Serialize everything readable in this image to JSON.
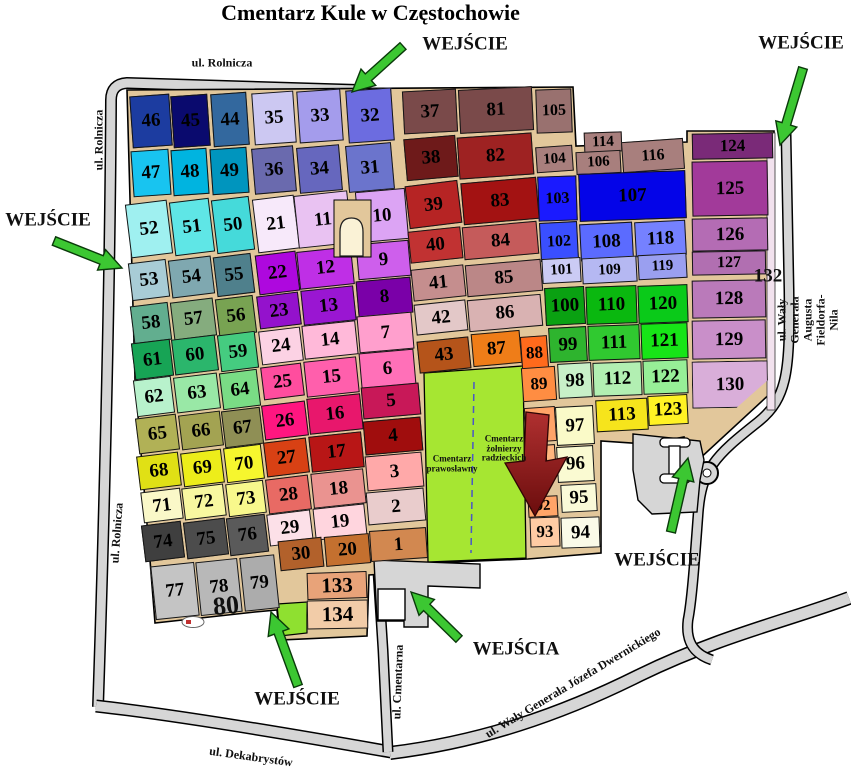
{
  "title": "Cmentarz Kule w Częstochowie",
  "colors": {
    "road": "#D6D6D6",
    "path_bg": "#E2C79B",
    "soviet_green": "#A6E632",
    "quad_green": "#8FE030",
    "arrow_green": "#3CC732",
    "arrow_green_edge": "#0A3A0A",
    "red_arrow_top": "#B03030",
    "red_arrow_bottom": "#6B0D0D",
    "chapel": "#FAF2D6",
    "building": "#FFFFFF",
    "strip": "#F2E2EE",
    "dash_line": "#4A55C8"
  },
  "special_areas": {
    "orthodox": "Cmentarz\nprawosławny",
    "soviet": "Cmentarz\nżołnierzy\nradzieckich"
  },
  "sections": [
    [
      "46",
      131,
      95,
      40,
      52,
      -4,
      "#1C3CA0"
    ],
    [
      "45",
      172,
      95,
      37,
      52,
      -4,
      "#0A0A6E"
    ],
    [
      "44",
      212,
      93,
      36,
      53,
      -4,
      "#33689E"
    ],
    [
      "35",
      253,
      92,
      42,
      52,
      -4,
      "#CCC8F2"
    ],
    [
      "33",
      298,
      90,
      44,
      52,
      -4,
      "#A49CEC"
    ],
    [
      "32",
      347,
      89,
      46,
      53,
      -4,
      "#6C6CE0"
    ],
    [
      "37",
      403,
      90,
      54,
      43,
      -3,
      "#7A4A4A"
    ],
    [
      "81",
      459,
      88,
      74,
      44,
      -3,
      "#7A4A4A"
    ],
    [
      "105",
      536,
      89,
      36,
      44,
      -2,
      "#99716F",
      16
    ],
    [
      "47",
      132,
      150,
      38,
      46,
      -4,
      "#18C4F0"
    ],
    [
      "48",
      172,
      149,
      36,
      46,
      -4,
      "#00B4E0"
    ],
    [
      "49",
      211,
      148,
      37,
      46,
      -4,
      "#0095BE"
    ],
    [
      "36",
      253,
      147,
      42,
      46,
      -5,
      "#6A6AAE"
    ],
    [
      "34",
      298,
      146,
      43,
      46,
      -5,
      "#6667BE"
    ],
    [
      "31",
      347,
      144,
      46,
      47,
      -5,
      "#6B74CC"
    ],
    [
      "38",
      405,
      137,
      52,
      42,
      -5,
      "#6E1A1A"
    ],
    [
      "82",
      458,
      135,
      75,
      42,
      -4,
      "#9E2222"
    ],
    [
      "104",
      536,
      146,
      37,
      26,
      -4,
      "#A87F7D",
      15
    ],
    [
      "114",
      584,
      132,
      38,
      20,
      -2,
      "#A87F7D",
      15
    ],
    [
      "106",
      576,
      151,
      45,
      23,
      -3,
      "#A87F7D",
      15
    ],
    [
      "116",
      622,
      140,
      62,
      31,
      -4,
      "#A87F7D",
      16
    ],
    [
      "124",
      692,
      133,
      81,
      26,
      -1,
      "#7A2A78",
      17
    ],
    [
      "52",
      128,
      202,
      42,
      54,
      -7,
      "#9FF0F0"
    ],
    [
      "51",
      172,
      200,
      40,
      54,
      -7,
      "#5FE6E6"
    ],
    [
      "50",
      214,
      198,
      38,
      54,
      -7,
      "#45DADA"
    ],
    [
      "21",
      255,
      197,
      42,
      54,
      -7,
      "#F7E9FA"
    ],
    [
      "11",
      296,
      193,
      54,
      53,
      -6,
      "#E9C2F2"
    ],
    [
      "10",
      357,
      190,
      50,
      51,
      -5,
      "#DCA4F4"
    ],
    [
      "39",
      407,
      183,
      53,
      43,
      -7,
      "#B62424"
    ],
    [
      "83",
      462,
      180,
      76,
      42,
      -5,
      "#A31212"
    ],
    [
      "103",
      538,
      176,
      39,
      45,
      -2,
      "#1A1AFF",
      16
    ],
    [
      "107",
      579,
      172,
      107,
      48,
      -2,
      "#0404E8"
    ],
    [
      "125",
      692,
      161,
      76,
      55,
      -1,
      "#A23A9A"
    ],
    [
      "53",
      130,
      261,
      38,
      38,
      -7,
      "#A8CCD6"
    ],
    [
      "54",
      170,
      258,
      43,
      38,
      -7,
      "#7FA8B0"
    ],
    [
      "55",
      215,
      255,
      38,
      40,
      -7,
      "#4F808C"
    ],
    [
      "22",
      257,
      253,
      41,
      40,
      -7,
      "#AE08DE"
    ],
    [
      "12",
      298,
      249,
      55,
      38,
      -6,
      "#BF2FE6"
    ],
    [
      "9",
      357,
      242,
      53,
      36,
      -5,
      "#CE5FEC"
    ],
    [
      "40",
      409,
      229,
      53,
      32,
      -6,
      "#C13232"
    ],
    [
      "84",
      463,
      224,
      75,
      33,
      -5,
      "#C55B5B"
    ],
    [
      "102",
      540,
      222,
      38,
      39,
      -3,
      "#3A4FFF",
      16
    ],
    [
      "108",
      580,
      223,
      53,
      37,
      -3,
      "#5B6BFF"
    ],
    [
      "118",
      635,
      221,
      51,
      35,
      -3,
      "#7581FF"
    ],
    [
      "126",
      692,
      218,
      76,
      33,
      -1,
      "#B46CB4"
    ],
    [
      "58",
      132,
      304,
      38,
      38,
      -7,
      "#62AE8F"
    ],
    [
      "57",
      172,
      300,
      43,
      38,
      -7,
      "#85AC7E"
    ],
    [
      "56",
      217,
      297,
      38,
      38,
      -7,
      "#78A352"
    ],
    [
      "23",
      258,
      294,
      42,
      33,
      -7,
      "#9412CC"
    ],
    [
      "13",
      302,
      288,
      53,
      35,
      -6,
      "#9A16D2"
    ],
    [
      "8",
      357,
      279,
      55,
      36,
      -5,
      "#7A00A8"
    ],
    [
      "41",
      412,
      267,
      53,
      32,
      -6,
      "#C58E8E"
    ],
    [
      "85",
      466,
      262,
      76,
      32,
      -5,
      "#BB8787"
    ],
    [
      "101",
      542,
      258,
      39,
      25,
      -3,
      "#CBCBF4",
      15
    ],
    [
      "109",
      582,
      257,
      55,
      26,
      -3,
      "#B5B8F2",
      15
    ],
    [
      "119",
      638,
      254,
      49,
      25,
      -3,
      "#9A9FF0",
      15
    ],
    [
      "127",
      692,
      251,
      74,
      24,
      -1,
      "#B16FB1",
      16
    ],
    [
      "61",
      133,
      341,
      39,
      37,
      -7,
      "#17A455"
    ],
    [
      "60",
      173,
      337,
      44,
      36,
      -7,
      "#2BB66C"
    ],
    [
      "59",
      219,
      333,
      38,
      37,
      -7,
      "#45CC80"
    ],
    [
      "24",
      260,
      329,
      42,
      34,
      -7,
      "#FCD2E4"
    ],
    [
      "14",
      303,
      323,
      54,
      34,
      -6,
      "#FFB9D9"
    ],
    [
      "7",
      358,
      314,
      55,
      37,
      -5,
      "#FF9FCD"
    ],
    [
      "42",
      415,
      302,
      52,
      31,
      -6,
      "#E3C8C8"
    ],
    [
      "86",
      468,
      297,
      74,
      32,
      -5,
      "#D9B2B2"
    ],
    [
      "100",
      545,
      287,
      40,
      38,
      -3,
      "#0AA112"
    ],
    [
      "110",
      586,
      286,
      51,
      38,
      -2,
      "#0AB80F"
    ],
    [
      "120",
      638,
      285,
      50,
      38,
      -2,
      "#0ACA19"
    ],
    [
      "128",
      692,
      280,
      74,
      38,
      -1,
      "#BA7ABA"
    ],
    [
      "62",
      135,
      378,
      38,
      37,
      -7,
      "#B8F2CC"
    ],
    [
      "63",
      175,
      375,
      44,
      36,
      -7,
      "#99E8A6"
    ],
    [
      "64",
      221,
      371,
      38,
      37,
      -7,
      "#7ADC85"
    ],
    [
      "25",
      262,
      365,
      41,
      33,
      -7,
      "#FF4D9E"
    ],
    [
      "15",
      305,
      359,
      53,
      36,
      -6,
      "#FF5FAC"
    ],
    [
      "6",
      360,
      351,
      55,
      36,
      -5,
      "#FF70B8"
    ],
    [
      "43",
      418,
      339,
      52,
      32,
      -6,
      "#B5541A"
    ],
    [
      "87",
      472,
      332,
      49,
      33,
      -5,
      "#EF7D18"
    ],
    [
      "88",
      521,
      336,
      27,
      34,
      -4,
      "#FF6A1C",
      17
    ],
    [
      "99",
      549,
      327,
      38,
      35,
      -3,
      "#2EB42E"
    ],
    [
      "111",
      588,
      325,
      52,
      35,
      -2,
      "#30C930"
    ],
    [
      "121",
      641,
      323,
      47,
      36,
      -2,
      "#17E517"
    ],
    [
      "129",
      692,
      320,
      74,
      39,
      -1,
      "#C98FC9"
    ],
    [
      "65",
      137,
      416,
      41,
      36,
      -7,
      "#B1B156"
    ],
    [
      "66",
      180,
      413,
      42,
      35,
      -7,
      "#A3A352"
    ],
    [
      "67",
      223,
      409,
      39,
      37,
      -7,
      "#8F8F55"
    ],
    [
      "26",
      263,
      403,
      44,
      35,
      -7,
      "#FF1680"
    ],
    [
      "16",
      308,
      396,
      54,
      36,
      -6,
      "#E8176C"
    ],
    [
      "5",
      362,
      385,
      58,
      32,
      -5,
      "#C81858"
    ],
    [
      "89",
      522,
      367,
      34,
      34,
      -4,
      "#FF8D42",
      17
    ],
    [
      "98",
      558,
      363,
      34,
      35,
      -3,
      "#C8F0C8"
    ],
    [
      "112",
      593,
      362,
      49,
      34,
      -2,
      "#B2EFB2"
    ],
    [
      "122",
      643,
      360,
      45,
      34,
      -2,
      "#97EF97"
    ],
    [
      "130",
      692,
      361,
      76,
      47,
      -1,
      "#D9AED9",
      19,
      "polygon(0 0,100% 0,100% 42%,58% 100%,0 100%)"
    ],
    [
      "68",
      138,
      454,
      42,
      34,
      -7,
      "#E0E015"
    ],
    [
      "69",
      182,
      451,
      41,
      34,
      -7,
      "#EDED1A"
    ],
    [
      "70",
      225,
      446,
      38,
      35,
      -7,
      "#F6F62E"
    ],
    [
      "27",
      265,
      440,
      43,
      35,
      -7,
      "#D84114"
    ],
    [
      "17",
      310,
      434,
      53,
      36,
      -6,
      "#B81616"
    ],
    [
      "4",
      364,
      419,
      58,
      34,
      -5,
      "#A00D0D"
    ],
    [
      "90",
      525,
      407,
      31,
      35,
      -4,
      "#FFA468",
      17
    ],
    [
      "97",
      556,
      406,
      38,
      39,
      -3,
      "#FAFAC8"
    ],
    [
      "113",
      596,
      399,
      52,
      32,
      -3,
      "#F6E41C"
    ],
    [
      "123",
      648,
      395,
      40,
      30,
      -3,
      "#FFF224"
    ],
    [
      "71",
      142,
      490,
      40,
      31,
      -7,
      "#FAF8C8"
    ],
    [
      "72",
      183,
      486,
      42,
      32,
      -7,
      "#F8F8A0"
    ],
    [
      "73",
      227,
      482,
      38,
      33,
      -7,
      "#F8F88C"
    ],
    [
      "28",
      267,
      477,
      43,
      35,
      -7,
      "#E86A64"
    ],
    [
      "18",
      312,
      471,
      53,
      35,
      -6,
      "#EA9390"
    ],
    [
      "3",
      366,
      454,
      57,
      35,
      -5,
      "#FFA9A9"
    ],
    [
      "91",
      527,
      445,
      29,
      33,
      -4,
      "#FFB67E",
      17
    ],
    [
      "96",
      557,
      446,
      37,
      36,
      -3,
      "#FAFAD2"
    ],
    [
      "74",
      143,
      523,
      40,
      37,
      -7,
      "#3F3F3F"
    ],
    [
      "75",
      185,
      520,
      42,
      37,
      -7,
      "#4C4C4C"
    ],
    [
      "76",
      228,
      516,
      39,
      38,
      -7,
      "#5A5A5A"
    ],
    [
      "29",
      268,
      512,
      44,
      32,
      -7,
      "#FCE0E8"
    ],
    [
      "19",
      314,
      506,
      52,
      32,
      -6,
      "#FFD5DE"
    ],
    [
      "2",
      367,
      490,
      58,
      33,
      -5,
      "#E9CCCC"
    ],
    [
      "92",
      528,
      496,
      30,
      21,
      -3,
      "#FFA468",
      15
    ],
    [
      "95",
      561,
      484,
      36,
      28,
      -3,
      "#FAFAD8"
    ],
    [
      "77",
      153,
      564,
      44,
      54,
      -6,
      "#C4C4C4"
    ],
    [
      "78",
      198,
      560,
      42,
      54,
      -6,
      "#B8B8B8"
    ],
    [
      "79",
      242,
      556,
      35,
      54,
      -6,
      "#ACACAC"
    ],
    [
      "30",
      279,
      539,
      44,
      30,
      -6,
      "#B2612B"
    ],
    [
      "20",
      325,
      535,
      45,
      30,
      -5,
      "#C4702F"
    ],
    [
      "1",
      370,
      529,
      57,
      31,
      -4,
      "#D28850"
    ],
    [
      "93",
      530,
      517,
      30,
      30,
      -2,
      "#FFCBA4",
      17
    ],
    [
      "94",
      561,
      517,
      39,
      31,
      -2,
      "#FAFAE8"
    ],
    [
      "133",
      307,
      572,
      60,
      27,
      -2,
      "#E8A379",
      21
    ],
    [
      "134",
      307,
      600,
      61,
      29,
      -1,
      "#F2CCA8",
      21
    ]
  ],
  "labels": [
    [
      "WEJŚCIE",
      465,
      45,
      0,
      19
    ],
    [
      "WEJŚCIE",
      801,
      44,
      0,
      19
    ],
    [
      "WEJŚCIE",
      48,
      221,
      0,
      19
    ],
    [
      "WEJŚCIE",
      297,
      700,
      0,
      19
    ],
    [
      "WEJŚCIA",
      516,
      650,
      0,
      19
    ],
    [
      "WEJŚCIE",
      657,
      561,
      0,
      19
    ],
    [
      "ul. Rolnicza",
      222,
      63,
      0,
      12
    ],
    [
      "ul. Rolnicza",
      99,
      140,
      -90,
      12
    ],
    [
      "ul. Rolnicza",
      117,
      533,
      -86,
      12
    ],
    [
      "ul. Wały Generała Augusta Fieldorfa-Nila",
      808,
      320,
      -90,
      12
    ],
    [
      "ul. Cmentarna",
      398,
      682,
      -88,
      12
    ],
    [
      "ul. Wały Generała Józefa Dwernickiego",
      573,
      683,
      -31,
      12
    ],
    [
      "ul. Dekabrystów",
      251,
      757,
      8,
      12
    ],
    [
      "80",
      226,
      606,
      -6,
      26
    ],
    [
      "132",
      768,
      277,
      0,
      19
    ],
    [
      "Cmentarz\nprawosławny",
      452,
      464,
      0,
      9
    ],
    [
      "Cmentarz\nżołnierzy\nradzieckich",
      504,
      449,
      0,
      9
    ]
  ],
  "green_arrows": [
    [
      403,
      46,
      352,
      92
    ],
    [
      803,
      68,
      780,
      145
    ],
    [
      54,
      241,
      122,
      268
    ],
    [
      298,
      686,
      271,
      612
    ],
    [
      459,
      639,
      411,
      592
    ],
    [
      671,
      532,
      688,
      458
    ]
  ],
  "red_arrow_points": "526,412 549,415 546,461 567,457 535,516 505,463 524,461"
}
